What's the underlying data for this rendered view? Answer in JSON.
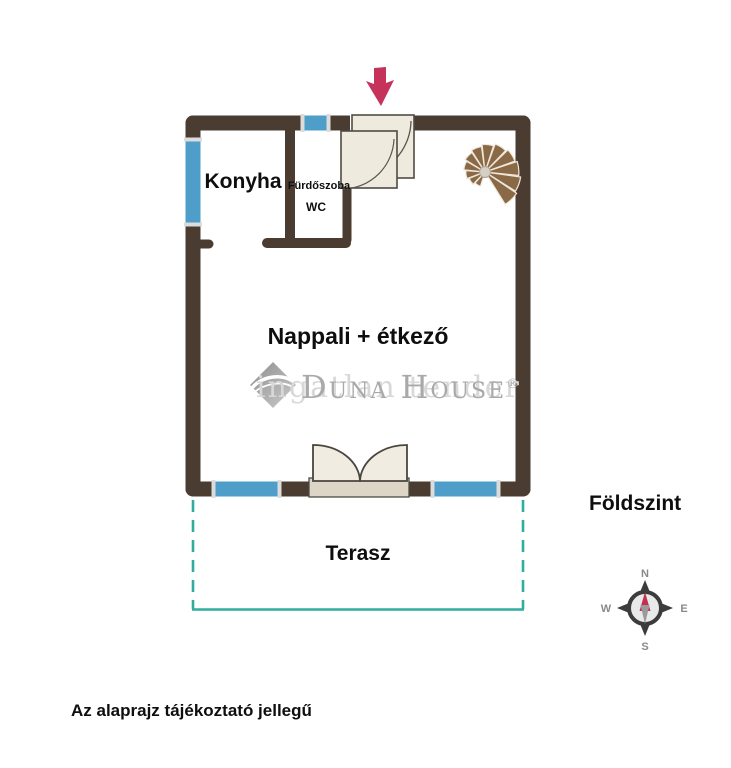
{
  "labels": {
    "kitchen": "Konyha",
    "bathroom": "Fürdőszoba",
    "wc": "WC",
    "living_dining": "Nappali + étkező",
    "terrace": "Terasz",
    "floor": "Földszint",
    "disclaimer": "Az alaprajz tájékoztató jellegű"
  },
  "watermark": {
    "brand": "Duna House",
    "registered": "®",
    "background_text": "ingatlan tender"
  },
  "compass": {
    "north": "N",
    "east": "E",
    "south": "S",
    "west": "W"
  },
  "colors": {
    "wall": "#4b3c32",
    "window": "#4e9ec9",
    "door": "#efeade",
    "door_sill": "#ddd6c7",
    "stair": "#8a6947",
    "terrace_line": "#2fae9e",
    "entry_arrow": "#c5335a",
    "watermark_gray": "#a9a9a9",
    "compass_dark": "#3c3c3c",
    "compass_needle_red": "#c23154",
    "text": "#0e0e0e"
  }
}
